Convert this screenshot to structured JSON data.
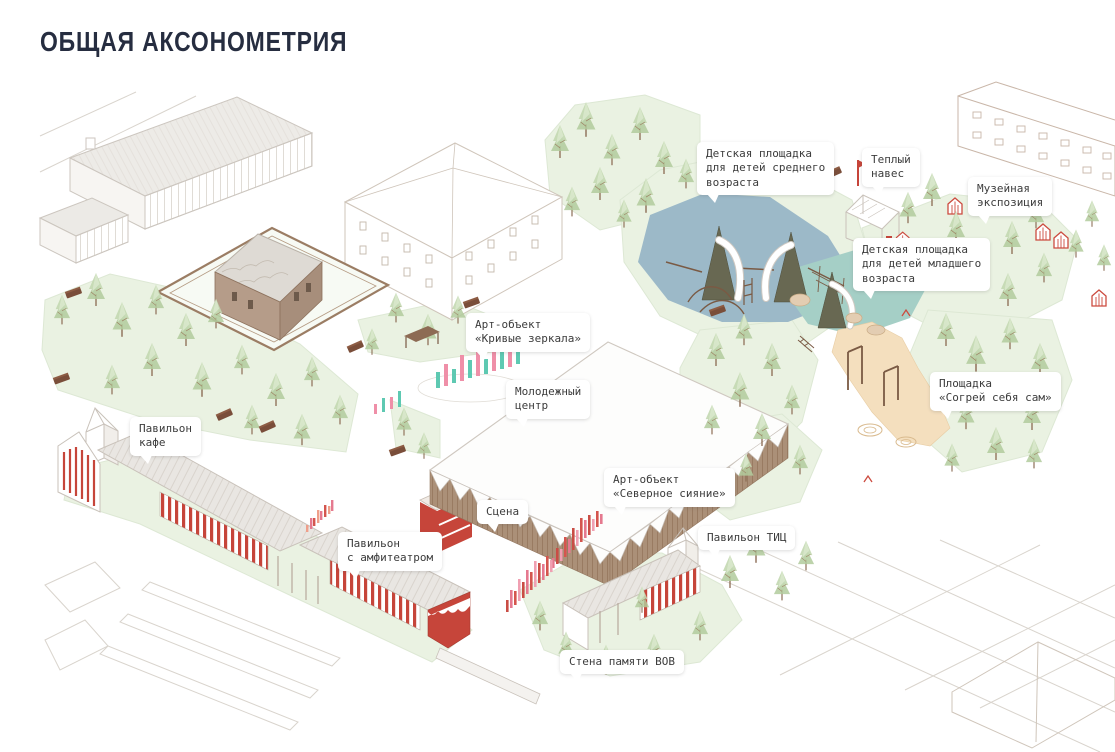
{
  "title": "ОБЩАЯ АКСОНОМЕТРИЯ",
  "colors": {
    "title_navy": "#262d40",
    "accent_red": "#c6453a",
    "playground_blue": "#9cb9c8",
    "playground_teal": "#a5cfc6",
    "sand_beige": "#f4dfbe",
    "lawn_green": "#eaf2e2",
    "tree_green": "#bcd3aa",
    "wood_brown": "#a98d77",
    "mirror_teal": "#5ec9b2",
    "mirror_pink": "#ef8fa8"
  },
  "labels": [
    {
      "id": "playground-middle",
      "text": "Детская площадка\nдля детей среднего\nвозраста"
    },
    {
      "id": "warm-canopy",
      "text": "Теплый\nнавес"
    },
    {
      "id": "museum-expo",
      "text": "Музейная\nэкспозиция"
    },
    {
      "id": "playground-younger",
      "text": "Детская площадка\nдля детей младшего\nвозраста"
    },
    {
      "id": "art-mirrors",
      "text": "Арт-объект\n«Кривые зеркала»"
    },
    {
      "id": "youth-center",
      "text": "Молодежный\nцентр"
    },
    {
      "id": "warm-yourself",
      "text": "Площадка\n«Согрей себя сам»"
    },
    {
      "id": "cafe-pavilion",
      "text": "Павильон\nкафе"
    },
    {
      "id": "art-northern-lights",
      "text": "Арт-объект\n«Северное сияние»"
    },
    {
      "id": "stage",
      "text": "Сцена"
    },
    {
      "id": "amphitheater-pavilion",
      "text": "Павильон\nс амфитеатром"
    },
    {
      "id": "tic-pavilion",
      "text": "Павильон ТИЦ"
    },
    {
      "id": "wwii-memory-wall",
      "text": "Стена памяти ВОВ"
    }
  ]
}
